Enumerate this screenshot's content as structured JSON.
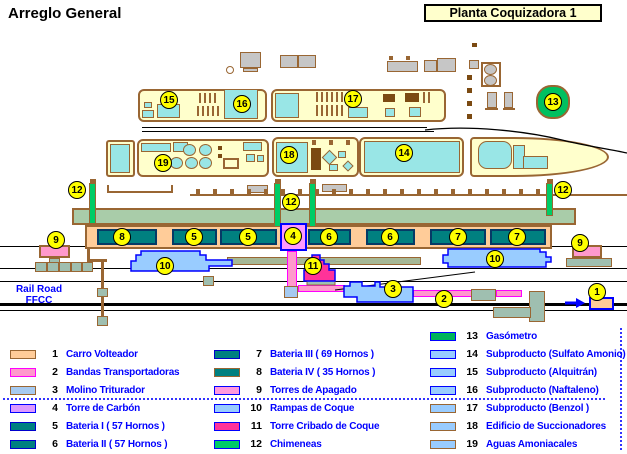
{
  "title": "Arreglo General",
  "plant_label": "Planta Coquizadora 1",
  "railroad": {
    "line1": "Rail Road",
    "line2": "FFCC"
  },
  "colors": {
    "outline_brown": "#996633",
    "building_cream": "#FFFFCC",
    "unit_cyan": "#99E6E6",
    "battery_teal": "#008080",
    "coal_band_orange": "#FFCC99",
    "conveyor_green": "#A9CCA9",
    "chimney_green": "#00CC66",
    "gasometer_green": "#00C060",
    "coal_tower_violet": "#FF99FF",
    "screen_tower_magenta": "#FF3399",
    "ramp_blue": "#99CCFF",
    "quench_pink": "#FF99CC",
    "marker_yellow": "#FFFF00",
    "legend_text": "#0000FF"
  },
  "map": {
    "markers": [
      {
        "label": "15",
        "x": 169,
        "y": 100
      },
      {
        "label": "16",
        "x": 242,
        "y": 104
      },
      {
        "label": "17",
        "x": 353,
        "y": 99
      },
      {
        "label": "13",
        "x": 553,
        "y": 102
      },
      {
        "label": "19",
        "x": 163,
        "y": 163
      },
      {
        "label": "18",
        "x": 289,
        "y": 155
      },
      {
        "label": "14",
        "x": 404,
        "y": 153
      },
      {
        "label": "12",
        "x": 77,
        "y": 190
      },
      {
        "label": "12",
        "x": 291,
        "y": 202
      },
      {
        "label": "12",
        "x": 563,
        "y": 190
      },
      {
        "label": "9",
        "x": 56,
        "y": 240
      },
      {
        "label": "9",
        "x": 580,
        "y": 243
      },
      {
        "label": "8",
        "x": 122,
        "y": 237
      },
      {
        "label": "5",
        "x": 194,
        "y": 237
      },
      {
        "label": "5",
        "x": 248,
        "y": 237
      },
      {
        "label": "4",
        "x": 293,
        "y": 236
      },
      {
        "label": "6",
        "x": 329,
        "y": 237
      },
      {
        "label": "6",
        "x": 390,
        "y": 237
      },
      {
        "label": "7",
        "x": 458,
        "y": 237
      },
      {
        "label": "7",
        "x": 517,
        "y": 237
      },
      {
        "label": "10",
        "x": 165,
        "y": 266
      },
      {
        "label": "10",
        "x": 495,
        "y": 259
      },
      {
        "label": "11",
        "x": 313,
        "y": 266
      },
      {
        "label": "3",
        "x": 393,
        "y": 289
      },
      {
        "label": "2",
        "x": 444,
        "y": 299
      },
      {
        "label": "1",
        "x": 597,
        "y": 292
      }
    ]
  },
  "legend": {
    "columns": [
      {
        "x": 10,
        "first_row_y": 354,
        "items": [
          {
            "num": "1",
            "label": "Carro Volteador",
            "fill": "#FFCC99",
            "border": "#996633"
          },
          {
            "num": "2",
            "label": "Bandas Transportadoras",
            "fill": "#FF99CC",
            "border": "#FF00FF"
          },
          {
            "num": "3",
            "label": "Molino Triturador",
            "fill": "#A6CAF0",
            "border": "#996633"
          },
          {
            "num": "4",
            "label": "Torre de Carbón",
            "fill": "#DD99FF",
            "border": "#0000FF"
          },
          {
            "num": "5",
            "label": "Bateria I  ( 57 Hornos )",
            "fill": "#008080",
            "border": "#0000CC"
          },
          {
            "num": "6",
            "label": "Bateria II ( 57 Hornos )",
            "fill": "#008080",
            "border": "#0000CC"
          }
        ]
      },
      {
        "x": 214,
        "first_row_y": 354,
        "items": [
          {
            "num": "7",
            "label": "Bateria III  ( 69 Hornos )",
            "fill": "#008080",
            "border": "#0000CC"
          },
          {
            "num": "8",
            "label": "Bateria IV  ( 35 Hornos )",
            "fill": "#008080",
            "border": "#996633"
          },
          {
            "num": "9",
            "label": "Torres de Apagado",
            "fill": "#FF99DD",
            "border": "#0000FF"
          },
          {
            "num": "10",
            "label": "Rampas de Coque",
            "fill": "#99CCFF",
            "border": "#0000FF"
          },
          {
            "num": "11",
            "label": "Torre Cribado de Coque",
            "fill": "#FF3399",
            "border": "#0000FF"
          },
          {
            "num": "12",
            "label": "Chimeneas",
            "fill": "#00CC66",
            "border": "#0000FF"
          }
        ]
      },
      {
        "x": 430,
        "first_row_y": 336,
        "items": [
          {
            "num": "13",
            "label": "Gasómetro",
            "fill": "#00B35A",
            "border": "#0000FF"
          },
          {
            "num": "14",
            "label": "Subproducto (Sulfato Amonio)",
            "fill": "#99CCFF",
            "border": "#0000FF"
          },
          {
            "num": "15",
            "label": "Subproducto (Alquitrán)",
            "fill": "#99CCFF",
            "border": "#0000FF"
          },
          {
            "num": "16",
            "label": "Subproducto (Naftaleno)",
            "fill": "#99CCFF",
            "border": "#0000FF"
          },
          {
            "num": "17",
            "label": "Subproducto (Benzol )",
            "fill": "#99CCFF",
            "border": "#996633"
          },
          {
            "num": "18",
            "label": "Edificio de Succionadores",
            "fill": "#99CCFF",
            "border": "#996633"
          },
          {
            "num": "19",
            "label": "Aguas Amoniacales",
            "fill": "#99CCFF",
            "border": "#996633"
          }
        ]
      }
    ]
  }
}
